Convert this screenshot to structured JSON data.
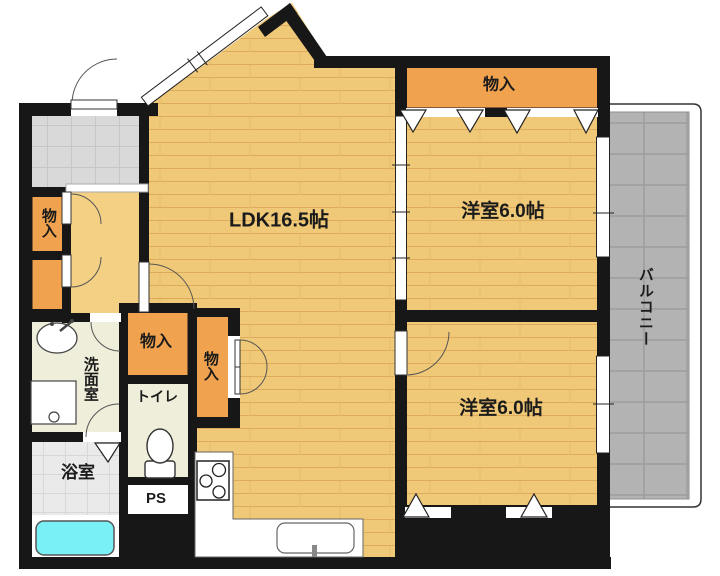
{
  "plan": {
    "type": "apartment-floor-plan",
    "labels": {
      "ldk": "LDK16.5帖",
      "bedroom1": "洋室6.0帖",
      "bedroom2": "洋室6.0帖",
      "balcony": "バルコニー",
      "closet_bedroom": "物入",
      "closet_entry": "物入",
      "closet_hall_a": "物入",
      "closet_hall_b": "物入",
      "washroom": "洗面室",
      "toilet": "トイレ",
      "bathroom": "浴室",
      "pipe_space": "PS"
    },
    "colors": {
      "wall": "#171717",
      "wood": "#f0c978",
      "wood-line": "#dcab5c",
      "hall": "#f4d085",
      "closet": "#f0a24e",
      "genkan-tile": "#d9d9d9",
      "balcony-tile": "#b3b3b3",
      "bath-tile": "#eaeaea",
      "wet-floor": "#efeeda",
      "bathtub": "#79f0f6",
      "outline": "#333333"
    }
  }
}
